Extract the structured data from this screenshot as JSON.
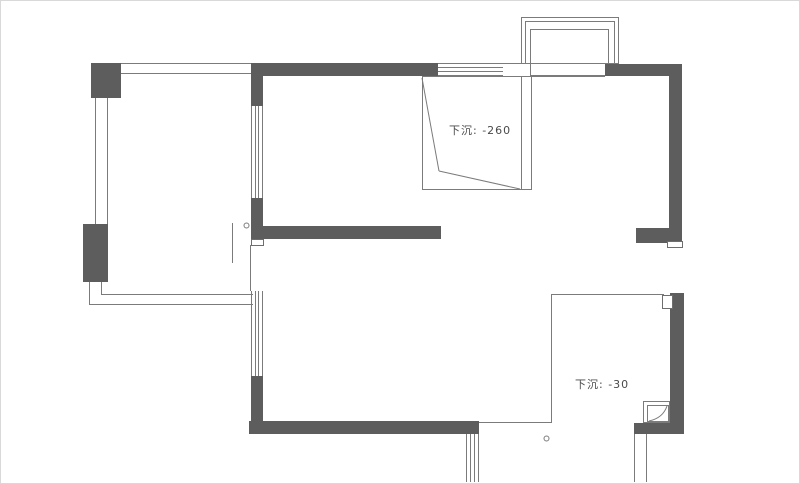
{
  "floor_plan": {
    "annotations": {
      "sunken_top": "下沉: -260",
      "sunken_bottom": "下沉: -30"
    },
    "colors": {
      "wall": "#5d5d5d",
      "line": "#7b7b7b",
      "text": "#4a4a4a",
      "background": "#ffffff"
    }
  }
}
